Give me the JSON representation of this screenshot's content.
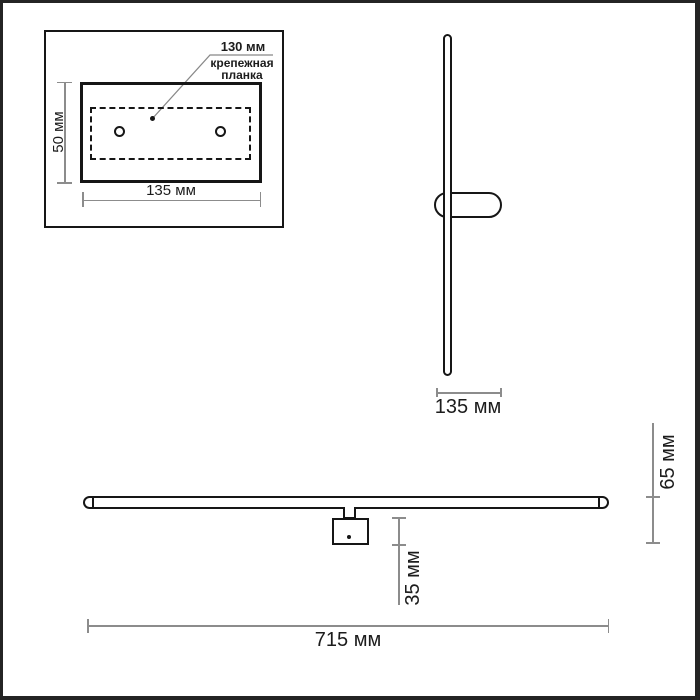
{
  "colors": {
    "outline": "#161616",
    "dimension": "#8c8c8c",
    "text": "#1c1c1c",
    "background": "#ffffff",
    "frame": "#242424"
  },
  "detail_inset": {
    "hole_spacing_label": "130 мм",
    "part_name_line1": "крепежная",
    "part_name_line2": "планка",
    "plate_height_label": "50 мм",
    "plate_width_label": "135 мм"
  },
  "side_view": {
    "mount_width_label": "135 мм"
  },
  "front_view": {
    "total_depth_label": "65 мм",
    "bracket_depth_label": "35 мм",
    "total_length_label": "715 мм"
  }
}
